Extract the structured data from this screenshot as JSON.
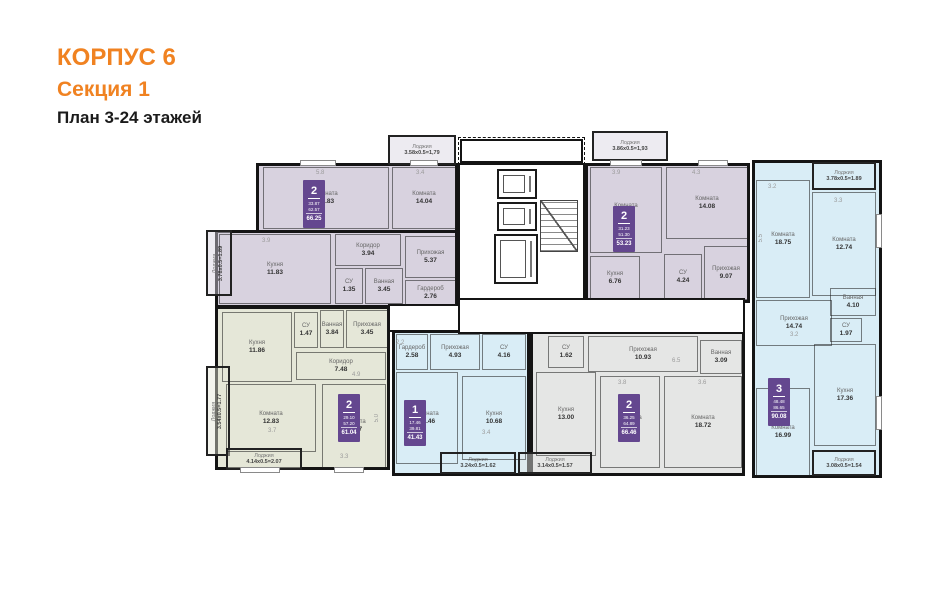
{
  "title": {
    "line1": "КОРПУС 6",
    "line2": "Секция 1",
    "line3": "План 3-24 этажей"
  },
  "colors": {
    "accent_orange": "#f08221",
    "badge_purple": "#64478f",
    "wall_black": "#141414",
    "fill_lavender": "#d8d2df",
    "fill_green": "#e5e7d8",
    "fill_blue": "#d9edf6",
    "fill_gray": "#e5e6e5"
  },
  "loggia_word": "Лоджия",
  "apartments": [
    {
      "id": "a1",
      "type": "2-room",
      "fill": "#d8d2df",
      "regions": [
        [
          256,
          163,
          202,
          70
        ],
        [
          215,
          230,
          243,
          78
        ]
      ],
      "rooms": [
        {
          "name": "Комната",
          "area": "19.83",
          "box": [
            263,
            167,
            126,
            62
          ]
        },
        {
          "name": "Комната",
          "area": "14.04",
          "box": [
            392,
            167,
            64,
            62
          ]
        },
        {
          "name": "Кухня",
          "area": "11.83",
          "box": [
            219,
            234,
            112,
            70
          ]
        },
        {
          "name": "Коридор",
          "area": "3.94",
          "box": [
            335,
            234,
            66,
            32
          ]
        },
        {
          "name": "СУ",
          "area": "1.35",
          "box": [
            335,
            268,
            28,
            36
          ]
        },
        {
          "name": "Ванная",
          "area": "3.45",
          "box": [
            365,
            268,
            38,
            36
          ]
        },
        {
          "name": "Прихожая",
          "area": "5.37",
          "box": [
            405,
            236,
            51,
            42
          ]
        },
        {
          "name": "Гардероб",
          "area": "2.76",
          "box": [
            405,
            280,
            51,
            26
          ]
        }
      ],
      "loggias": [
        {
          "formula": "3.58х0.5=1,79",
          "box": [
            388,
            135,
            68,
            30
          ],
          "vertical": false
        },
        {
          "formula": "3.78х0.5=1.89",
          "box": [
            206,
            230,
            26,
            66
          ],
          "vertical": true
        }
      ],
      "badge": {
        "rooms": "2",
        "living": "33.87",
        "area": "62.57",
        "total": "66.25",
        "box": [
          303,
          180,
          22,
          48
        ]
      }
    },
    {
      "id": "a2",
      "type": "2-room",
      "fill": "#e5e7d8",
      "regions": [
        [
          215,
          306,
          175,
          164
        ]
      ],
      "rooms": [
        {
          "name": "Кухня",
          "area": "11.86",
          "box": [
            222,
            312,
            70,
            70
          ]
        },
        {
          "name": "СУ",
          "area": "1.47",
          "box": [
            294,
            312,
            24,
            36
          ]
        },
        {
          "name": "Ванная",
          "area": "3.84",
          "box": [
            320,
            310,
            24,
            38
          ]
        },
        {
          "name": "Прихожая",
          "area": "3.45",
          "box": [
            346,
            310,
            42,
            38
          ]
        },
        {
          "name": "Коридор",
          "area": "7.48",
          "box": [
            296,
            352,
            90,
            28
          ]
        },
        {
          "name": "Комната",
          "area": "12.83",
          "box": [
            226,
            384,
            90,
            68
          ]
        },
        {
          "name": "Комната",
          "area": "16.27",
          "box": [
            322,
            384,
            64,
            84
          ]
        }
      ],
      "loggias": [
        {
          "formula": "3.54х0.5=1.77",
          "box": [
            206,
            366,
            24,
            90
          ],
          "vertical": true
        },
        {
          "formula": "4.14х0.5=2.07",
          "box": [
            226,
            448,
            76,
            22
          ],
          "vertical": false
        }
      ],
      "badge": {
        "rooms": "2",
        "living": "29.10",
        "area": "57.20",
        "total": "61.04",
        "box": [
          338,
          394,
          22,
          48
        ]
      }
    },
    {
      "id": "a3",
      "type": "1-room",
      "fill": "#d9edf6",
      "regions": [
        [
          392,
          330,
          138,
          146
        ]
      ],
      "rooms": [
        {
          "name": "Гардероб",
          "area": "2.58",
          "box": [
            396,
            334,
            32,
            36
          ]
        },
        {
          "name": "Прихожая",
          "area": "4.93",
          "box": [
            430,
            334,
            50,
            36
          ]
        },
        {
          "name": "СУ",
          "area": "4.16",
          "box": [
            482,
            334,
            44,
            36
          ]
        },
        {
          "name": "Комната",
          "area": "17.46",
          "box": [
            396,
            372,
            62,
            92
          ]
        },
        {
          "name": "Кухня",
          "area": "10.68",
          "box": [
            462,
            376,
            64,
            84
          ]
        }
      ],
      "loggias": [
        {
          "formula": "3.24х0.5=1.62",
          "box": [
            440,
            452,
            76,
            22
          ],
          "vertical": false
        }
      ],
      "badge": {
        "rooms": "1",
        "living": "17.46",
        "area": "39.81",
        "total": "41.43",
        "box": [
          404,
          400,
          22,
          46
        ]
      }
    },
    {
      "id": "a4",
      "type": "2-room",
      "fill": "#e5e6e5",
      "regions": [
        [
          530,
          330,
          215,
          146
        ]
      ],
      "rooms": [
        {
          "name": "СУ",
          "area": "1.62",
          "box": [
            548,
            336,
            36,
            32
          ]
        },
        {
          "name": "Прихожая",
          "area": "10.93",
          "box": [
            588,
            336,
            110,
            36
          ]
        },
        {
          "name": "Ванная",
          "area": "3.09",
          "box": [
            700,
            340,
            42,
            34
          ]
        },
        {
          "name": "Кухня",
          "area": "13.00",
          "box": [
            536,
            372,
            60,
            84
          ]
        },
        {
          "name": "Комната",
          "area": "17.53",
          "box": [
            600,
            376,
            60,
            92
          ]
        },
        {
          "name": "Комната",
          "area": "18.72",
          "box": [
            664,
            376,
            78,
            92
          ]
        }
      ],
      "loggias": [
        {
          "formula": "3.14х0.5=1.57",
          "box": [
            518,
            452,
            74,
            22
          ],
          "vertical": false
        }
      ],
      "badge": {
        "rooms": "2",
        "living": "36.25",
        "area": "64.89",
        "total": "66.46",
        "box": [
          618,
          394,
          22,
          48
        ]
      }
    },
    {
      "id": "a5",
      "type": "2-room",
      "fill": "#d8d2df",
      "regions": [
        [
          585,
          163,
          165,
          140
        ]
      ],
      "rooms": [
        {
          "name": "Комната",
          "area": "17.15",
          "box": [
            590,
            167,
            72,
            86
          ]
        },
        {
          "name": "Комната",
          "area": "14.08",
          "box": [
            666,
            167,
            82,
            72
          ]
        },
        {
          "name": "Кухня",
          "area": "6.76",
          "box": [
            590,
            256,
            50,
            44
          ]
        },
        {
          "name": "СУ",
          "area": "4.24",
          "box": [
            664,
            254,
            38,
            46
          ]
        },
        {
          "name": "Прихожая",
          "area": "9.07",
          "box": [
            704,
            246,
            44,
            54
          ]
        }
      ],
      "loggias": [
        {
          "formula": "3.86х0.5=1,93",
          "box": [
            592,
            131,
            76,
            30
          ],
          "vertical": false
        }
      ],
      "badge": {
        "rooms": "2",
        "living": "31.23",
        "area": "51.30",
        "total": "53.23",
        "box": [
          613,
          206,
          22,
          46
        ]
      }
    },
    {
      "id": "a6",
      "type": "3-room",
      "fill": "#d9edf6",
      "regions": [
        [
          752,
          160,
          130,
          318
        ]
      ],
      "rooms": [
        {
          "name": "Комната",
          "area": "18.75",
          "box": [
            756,
            180,
            54,
            118
          ]
        },
        {
          "name": "Комната",
          "area": "12.74",
          "box": [
            812,
            192,
            64,
            104
          ]
        },
        {
          "name": "Ванная",
          "area": "4.10",
          "box": [
            830,
            288,
            46,
            28
          ]
        },
        {
          "name": "Прихожая",
          "area": "14.74",
          "box": [
            756,
            300,
            76,
            46
          ]
        },
        {
          "name": "СУ",
          "area": "1.97",
          "box": [
            830,
            318,
            32,
            24
          ]
        },
        {
          "name": "Кухня",
          "area": "17.36",
          "box": [
            814,
            344,
            62,
            102
          ]
        },
        {
          "name": "Комната",
          "area": "16.99",
          "box": [
            756,
            388,
            54,
            88
          ]
        }
      ],
      "loggias": [
        {
          "formula": "3.78х0.5=1.89",
          "box": [
            812,
            162,
            64,
            28
          ],
          "vertical": false
        },
        {
          "formula": "3.08х0.5=1.54",
          "box": [
            812,
            450,
            64,
            26
          ],
          "vertical": false
        }
      ],
      "badge": {
        "rooms": "3",
        "living": "48.48",
        "area": "86.65",
        "total": "90.08",
        "box": [
          768,
          378,
          22,
          48
        ]
      }
    }
  ],
  "core": {
    "vestibule_box": [
      458,
      137,
      127,
      28
    ],
    "hall_box": [
      458,
      163,
      127,
      140
    ],
    "corridor_boxes": [
      [
        458,
        298,
        287,
        36
      ],
      [
        388,
        304,
        72,
        28
      ]
    ],
    "elevators": [
      [
        497,
        169,
        40,
        30
      ],
      [
        497,
        202,
        40,
        29
      ],
      [
        494,
        234,
        44,
        50
      ]
    ],
    "stairs_box": [
      540,
      200,
      38,
      52
    ]
  },
  "windows": [
    [
      300,
      160,
      36,
      6
    ],
    [
      410,
      160,
      28,
      6
    ],
    [
      610,
      160,
      32,
      6
    ],
    [
      698,
      160,
      30,
      6
    ],
    [
      240,
      467,
      40,
      6
    ],
    [
      334,
      467,
      30,
      6
    ],
    [
      876,
      214,
      6,
      34
    ],
    [
      876,
      396,
      6,
      34
    ]
  ],
  "dims": [
    {
      "t": "5.8",
      "x": 316,
      "y": 170
    },
    {
      "t": "3.4",
      "x": 416,
      "y": 170
    },
    {
      "t": "3.9",
      "x": 262,
      "y": 238
    },
    {
      "t": "3.9",
      "x": 612,
      "y": 170
    },
    {
      "t": "4.3",
      "x": 692,
      "y": 170
    },
    {
      "t": "3.2",
      "x": 768,
      "y": 184
    },
    {
      "t": "3.3",
      "x": 834,
      "y": 198
    },
    {
      "t": "5.5",
      "x": 758,
      "y": 234,
      "v": true
    },
    {
      "t": "3.7",
      "x": 268,
      "y": 428
    },
    {
      "t": "3.3",
      "x": 340,
      "y": 454
    },
    {
      "t": "5.0",
      "x": 374,
      "y": 414,
      "v": true
    },
    {
      "t": "3.4",
      "x": 482,
      "y": 430
    },
    {
      "t": "6.5",
      "x": 672,
      "y": 358
    },
    {
      "t": "3.8",
      "x": 618,
      "y": 380
    },
    {
      "t": "3.6",
      "x": 698,
      "y": 380
    },
    {
      "t": "2.2",
      "x": 396,
      "y": 340
    },
    {
      "t": "4.9",
      "x": 352,
      "y": 372
    },
    {
      "t": "3.2",
      "x": 790,
      "y": 332
    }
  ]
}
